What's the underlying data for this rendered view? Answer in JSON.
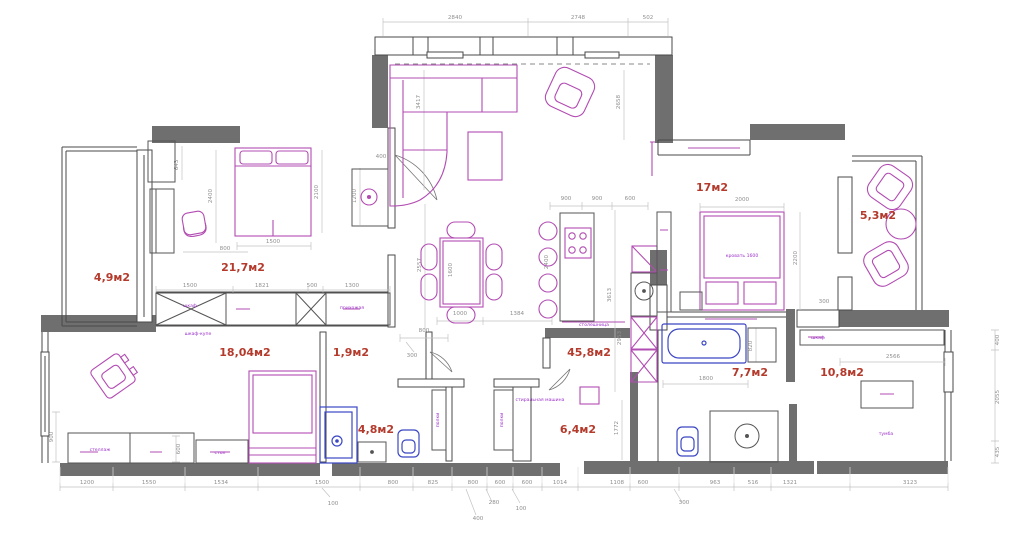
{
  "colors": {
    "wall": "#6f6f6f",
    "outline": "#4a4a4a",
    "furniture": "#b24cb2",
    "plumbing": "#3b47c4",
    "room_label": "#b43a2c",
    "dimension": "#8f8f8f"
  },
  "rooms": {
    "balcony_left": "4,9м2",
    "bedroom_main": "21,7м2",
    "study": "18,04м2",
    "hallway_small": "1,9м2",
    "bathroom_small": "4,8м2",
    "kitchen_living": "45,8м2",
    "corridor": "6,4м2",
    "bathroom_big": "7,7м2",
    "wardrobe_room": "10,8м2",
    "bedroom_second": "17м2",
    "balcony_right": "5,3м2"
  },
  "dims": {
    "top": [
      "2840",
      "2748",
      "502"
    ],
    "bottom": [
      "1200",
      "1550",
      "1534",
      "1500",
      "800",
      "825",
      "800",
      "600",
      "600",
      "1014",
      "1108",
      "600",
      "963",
      "516",
      "1321",
      "3123"
    ],
    "leaders": [
      "100",
      "400",
      "280",
      "100",
      "300"
    ],
    "bedroom_main": [
      "643",
      "2400",
      "800",
      "1500",
      "2100",
      "400",
      "1200"
    ],
    "bedroom_row": [
      "1500",
      "1821",
      "500",
      "1300"
    ],
    "living": [
      "3417",
      "2658"
    ],
    "kitchen_top": [
      "900",
      "900",
      "600"
    ],
    "kitchen_v": [
      "2557",
      "1600",
      "2400",
      "3613",
      "2953"
    ],
    "kitchen_bottom": [
      "1000",
      "1384"
    ],
    "bedroom_second": [
      "2000",
      "2200",
      "300"
    ],
    "bathroom_big": [
      "1800",
      "820",
      "1772"
    ],
    "wardrobe_room": [
      "2566"
    ],
    "right_side": [
      "400",
      "2055",
      "435"
    ],
    "left_side": [
      "900",
      "600"
    ],
    "hallway": [
      "800",
      "300"
    ]
  },
  "notes": [
    "шкаф",
    "шкаф-купе",
    "прихожая",
    "стеллаж",
    "стол",
    "кровать 1600",
    "полки",
    "полки",
    "стиральная машина",
    "тумба",
    "шкаф",
    "столешница"
  ]
}
